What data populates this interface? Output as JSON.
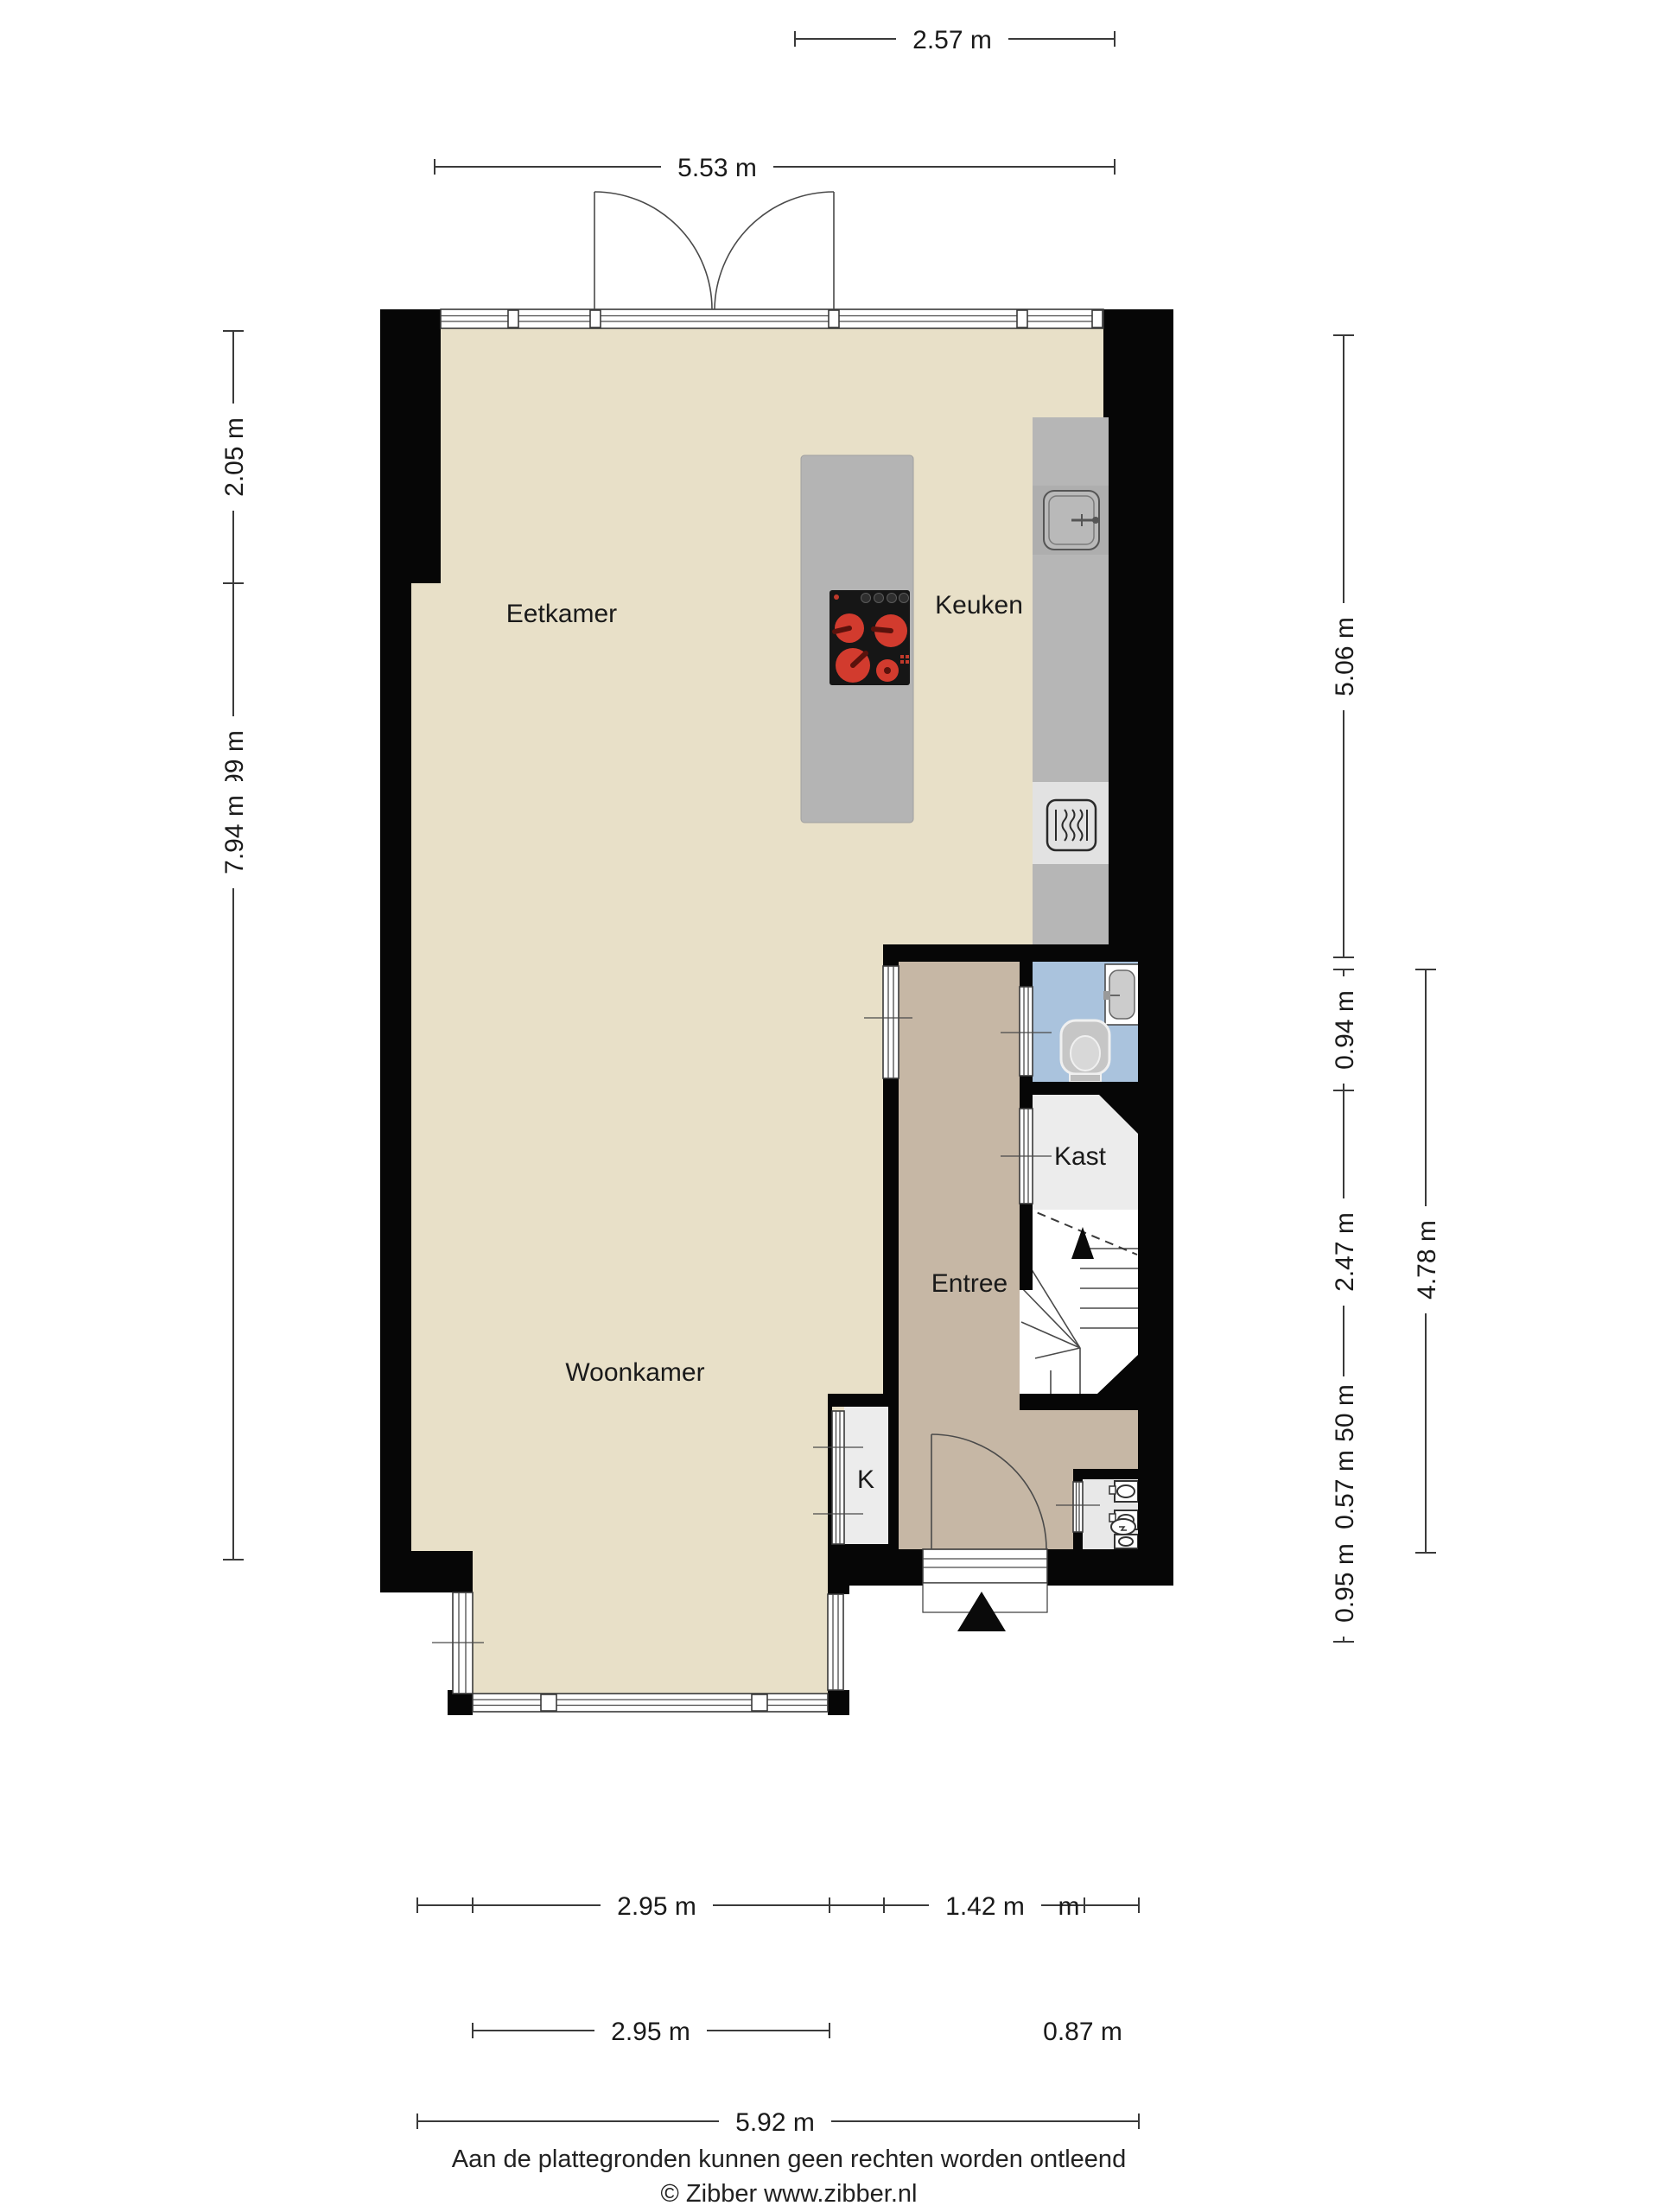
{
  "plan": {
    "type": "floorplan",
    "rooms": {
      "eetkamer": "Eetkamer",
      "keuken": "Keuken",
      "woonkamer": "Woonkamer",
      "entree": "Entree",
      "kast": "Kast",
      "k_closet": "K"
    },
    "colors": {
      "wall": "#060606",
      "living_floor": "#e8e0c8",
      "entree_floor": "#c6b7a5",
      "toilet_floor": "#aac3dd",
      "closet_floor": "#ececec",
      "counter": "#b6b6b6",
      "island": "#b4b4b4",
      "cooktop": "#161616",
      "burner_red": "#d23b2e"
    }
  },
  "dimensions": {
    "top": {
      "d257": "2.57 m",
      "d553": "5.53 m"
    },
    "left": {
      "d205": "2.05 m",
      "d999": "9.99 m",
      "d794": "7.94 m"
    },
    "right": {
      "d506": "5.06 m",
      "d094": "0.94 m",
      "d247": "2.47 m",
      "d050": "0.50 m",
      "d057": "0.57 m",
      "d095": "0.95 m",
      "d478": "4.78 m"
    },
    "bottom": {
      "d295a": "2.95 m",
      "d142": "1.42 m",
      "stray_m": "m",
      "d295b": "2.95 m",
      "d087": "0.87 m",
      "d592": "5.92 m"
    }
  },
  "footer": {
    "line1": "Aan de plattegronden kunnen geen rechten worden ontleend",
    "line2": "© Zibber www.zibber.nl"
  }
}
